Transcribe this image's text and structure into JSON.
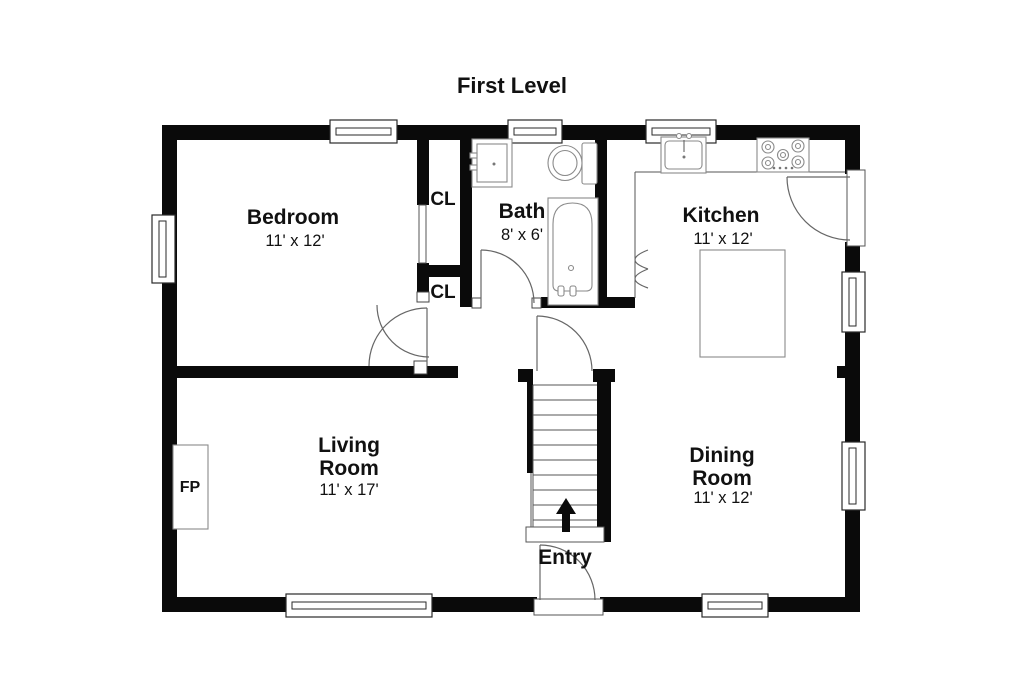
{
  "title": "First Level",
  "rooms": {
    "bedroom": {
      "name": "Bedroom",
      "dims": "11' x 12'"
    },
    "bath": {
      "name": "Bath",
      "dims": "8' x 6'"
    },
    "kitchen": {
      "name": "Kitchen",
      "dims": "11' x 12'"
    },
    "living": {
      "line1": "Living",
      "line2": "Room",
      "dims": "11' x 17'"
    },
    "dining": {
      "line1": "Dining",
      "line2": "Room",
      "dims": "11' x 12'"
    },
    "entry": {
      "name": "Entry"
    }
  },
  "labels": {
    "closet_upper": "CL",
    "closet_lower": "CL",
    "fireplace": "FP"
  },
  "fixtures": [
    "bathtub",
    "toilet",
    "bathroom-sink",
    "kitchen-sink",
    "stove",
    "kitchen-island",
    "fireplace",
    "staircase",
    "up-arrow"
  ],
  "colors": {
    "wall": "#0a0a0a",
    "thin_line": "#555555",
    "fixture_outline": "#8a8a8a",
    "background": "#ffffff",
    "text": "#111111"
  }
}
